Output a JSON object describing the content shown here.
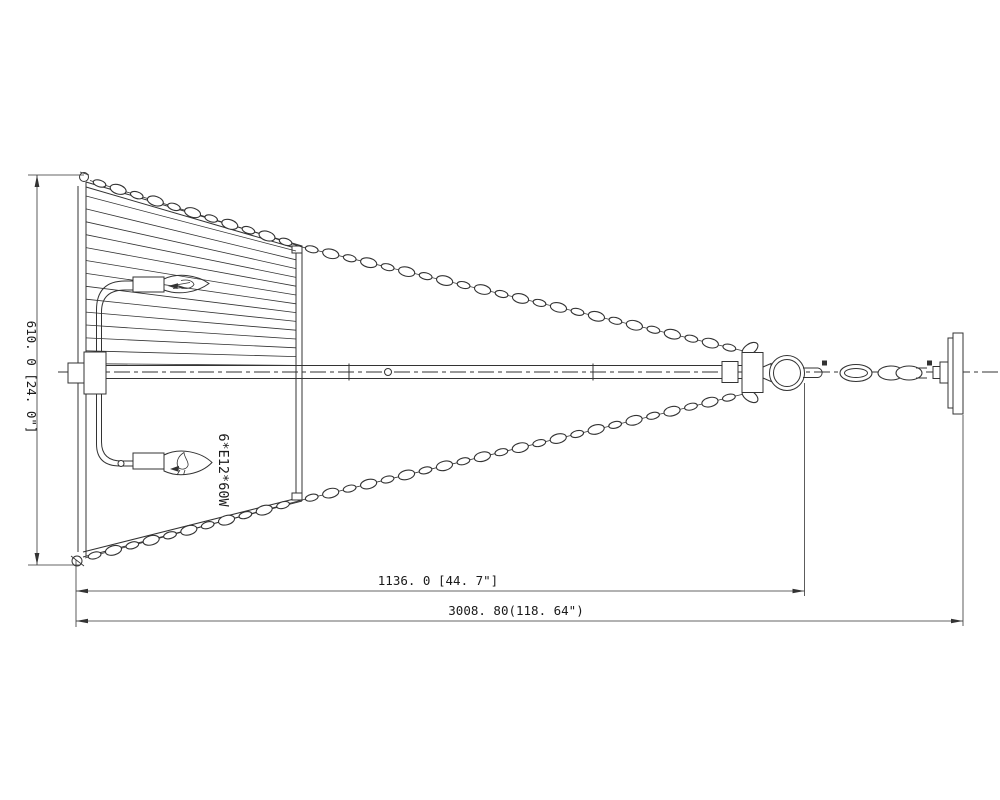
{
  "colors": {
    "line": "#333333",
    "text": "#1a1a1a",
    "background": "#ffffff"
  },
  "annotations": {
    "bulb_spec": "6*E12*60W"
  },
  "dimensions": {
    "height": "610. 0 [24. 0\"]",
    "suspension_length": "1136. 0 [44. 7\"]",
    "overall_length": "3008. 80(118. 64\")"
  }
}
